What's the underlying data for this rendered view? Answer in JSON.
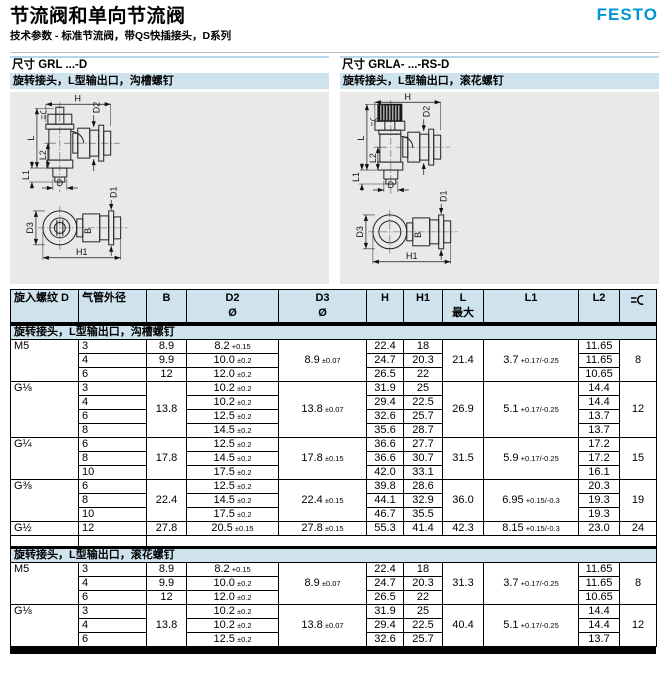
{
  "page": {
    "title": "节流阀和单向节流阀",
    "subtitle": "技术参数 - 标准节流阀，带QS快插接头，D系列",
    "brand": "FESTO"
  },
  "colors": {
    "festo_blue": "#0094d8",
    "band_blue": "#cfe3ee",
    "panel_gray": "#e9e9e9"
  },
  "sections": {
    "left": {
      "prefix": "尺寸",
      "code": "GRL ...-D",
      "desc": "旋转接头，L型输出口，沟槽螺钉"
    },
    "right": {
      "prefix": "尺寸",
      "code": "GRLA- ...-RS-D",
      "desc": "旋转接头，L型输出口，滚花螺钉"
    }
  },
  "drawing_labels": {
    "H": "H",
    "D2": "D2",
    "L": "L",
    "L2": "L2",
    "L1": "L1",
    "D": "D",
    "D3": "D3",
    "B": "B",
    "D1": "D1",
    "H1": "H1"
  },
  "table": {
    "headers": [
      {
        "key": "thread",
        "label": "旋入螺纹 D",
        "sub": ""
      },
      {
        "key": "od",
        "label": "气管外径",
        "sub": ""
      },
      {
        "key": "B",
        "label": "B",
        "sub": ""
      },
      {
        "key": "D2",
        "label": "D2",
        "sub": "Ø"
      },
      {
        "key": "D3",
        "label": "D3",
        "sub": "Ø"
      },
      {
        "key": "H",
        "label": "H",
        "sub": ""
      },
      {
        "key": "H1",
        "label": "H1",
        "sub": ""
      },
      {
        "key": "L",
        "label": "L",
        "sub": "最大"
      },
      {
        "key": "L1",
        "label": "L1",
        "sub": ""
      },
      {
        "key": "L2",
        "label": "L2",
        "sub": ""
      },
      {
        "key": "sw",
        "label": "",
        "sub": "",
        "icon": "wrench-icon"
      }
    ],
    "sections": [
      {
        "label": "旋转接头，L型输出口，沟槽螺钉",
        "groups": [
          {
            "thread": "M5",
            "merged": {
              "D3": {
                "v": "8.9",
                "t": "±0.07"
              },
              "L": "21.4",
              "L1": {
                "v": "3.7",
                "t": "+0.17/-0.25"
              },
              "sw": "8"
            },
            "rows": [
              {
                "od": "3",
                "B": "8.9",
                "D2": {
                  "v": "8.2",
                  "t": "+0.15"
                },
                "H": "22.4",
                "H1": "18",
                "L2": "11.65"
              },
              {
                "od": "4",
                "B": "9.9",
                "D2": {
                  "v": "10.0",
                  "t": "±0.2"
                },
                "H": "24.7",
                "H1": "20.3",
                "L2": "11.65"
              },
              {
                "od": "6",
                "B": "12",
                "D2": {
                  "v": "12.0",
                  "t": "±0.2"
                },
                "H": "26.5",
                "H1": "22",
                "L2": "10.65"
              }
            ]
          },
          {
            "thread": "G⅛",
            "B": "13.8",
            "merged": {
              "D3": {
                "v": "13.8",
                "t": "±0.07"
              },
              "L": "26.9",
              "L1": {
                "v": "5.1",
                "t": "+0.17/-0.25"
              },
              "sw": "12"
            },
            "rows": [
              {
                "od": "3",
                "D2": {
                  "v": "10.2",
                  "t": "±0.2"
                },
                "H": "31.9",
                "H1": "25",
                "L2": "14.4"
              },
              {
                "od": "4",
                "D2": {
                  "v": "10.2",
                  "t": "±0.2"
                },
                "H": "29.4",
                "H1": "22.5",
                "L2": "14.4"
              },
              {
                "od": "6",
                "D2": {
                  "v": "12.5",
                  "t": "±0.2"
                },
                "H": "32.6",
                "H1": "25.7",
                "L2": "13.7"
              },
              {
                "od": "8",
                "D2": {
                  "v": "14.5",
                  "t": "±0.2"
                },
                "H": "35.6",
                "H1": "28.7",
                "L2": "13.7"
              }
            ]
          },
          {
            "thread": "G¼",
            "B": "17.8",
            "merged": {
              "D3": {
                "v": "17.8",
                "t": "±0.15"
              },
              "L": "31.5",
              "L1": {
                "v": "5.9",
                "t": "+0.17/-0.25"
              },
              "sw": "15"
            },
            "rows": [
              {
                "od": "6",
                "D2": {
                  "v": "12.5",
                  "t": "±0.2"
                },
                "H": "36.6",
                "H1": "27.7",
                "L2": "17.2"
              },
              {
                "od": "8",
                "D2": {
                  "v": "14.5",
                  "t": "±0.2"
                },
                "H": "36.6",
                "H1": "30.7",
                "L2": "17.2"
              },
              {
                "od": "10",
                "D2": {
                  "v": "17.5",
                  "t": "±0.2"
                },
                "H": "42.0",
                "H1": "33.1",
                "L2": "16.1"
              }
            ]
          },
          {
            "thread": "G⅜",
            "B": "22.4",
            "merged": {
              "D3": {
                "v": "22.4",
                "t": "±0.15"
              },
              "L": "36.0",
              "L1": {
                "v": "6.95",
                "t": "+0.15/-0.3"
              },
              "sw": "19"
            },
            "rows": [
              {
                "od": "6",
                "D2": {
                  "v": "12.5",
                  "t": "±0.2"
                },
                "H": "39.8",
                "H1": "28.6",
                "L2": "20.3"
              },
              {
                "od": "8",
                "D2": {
                  "v": "14.5",
                  "t": "±0.2"
                },
                "H": "44.1",
                "H1": "32.9",
                "L2": "19.3"
              },
              {
                "od": "10",
                "D2": {
                  "v": "17.5",
                  "t": "±0.2"
                },
                "H": "46.7",
                "H1": "35.5",
                "L2": "19.3"
              }
            ]
          },
          {
            "thread": "G½",
            "B": "27.8",
            "merged": {
              "D3": {
                "v": "27.8",
                "t": "±0.15"
              },
              "L": "42.3",
              "L1": {
                "v": "8.15",
                "t": "+0.15/-0.3"
              },
              "sw": "24"
            },
            "rows": [
              {
                "od": "12",
                "D2": {
                  "v": "20.5",
                  "t": "±0.15"
                },
                "H": "55.3",
                "H1": "41.4",
                "L2": "23.0"
              }
            ]
          }
        ]
      },
      {
        "label": "旋转接头，L型输出口，滚花螺钉",
        "groups": [
          {
            "thread": "M5",
            "merged": {
              "D3": {
                "v": "8.9",
                "t": "±0.07"
              },
              "L": "31.3",
              "L1": {
                "v": "3.7",
                "t": "+0.17/-0.25"
              },
              "sw": "8"
            },
            "rows": [
              {
                "od": "3",
                "B": "8.9",
                "D2": {
                  "v": "8.2",
                  "t": "+0.15"
                },
                "H": "22.4",
                "H1": "18",
                "L2": "11.65"
              },
              {
                "od": "4",
                "B": "9.9",
                "D2": {
                  "v": "10.0",
                  "t": "±0.2"
                },
                "H": "24.7",
                "H1": "20.3",
                "L2": "11.65"
              },
              {
                "od": "6",
                "B": "12",
                "D2": {
                  "v": "12.0",
                  "t": "±0.2"
                },
                "H": "26.5",
                "H1": "22",
                "L2": "10.65"
              }
            ]
          },
          {
            "thread": "G⅛",
            "B": "13.8",
            "merged": {
              "D3": {
                "v": "13.8",
                "t": "±0.07"
              },
              "L": "40.4",
              "L1": {
                "v": "5.1",
                "t": "+0.17/-0.25"
              },
              "sw": "12"
            },
            "rows": [
              {
                "od": "3",
                "D2": {
                  "v": "10.2",
                  "t": "±0.2"
                },
                "H": "31.9",
                "H1": "25",
                "L2": "14.4"
              },
              {
                "od": "4",
                "D2": {
                  "v": "10.2",
                  "t": "±0.2"
                },
                "H": "29.4",
                "H1": "22.5",
                "L2": "14.4"
              },
              {
                "od": "6",
                "D2": {
                  "v": "12.5",
                  "t": "±0.2"
                },
                "H": "32.6",
                "H1": "25.7",
                "L2": "13.7"
              }
            ]
          }
        ]
      }
    ]
  }
}
